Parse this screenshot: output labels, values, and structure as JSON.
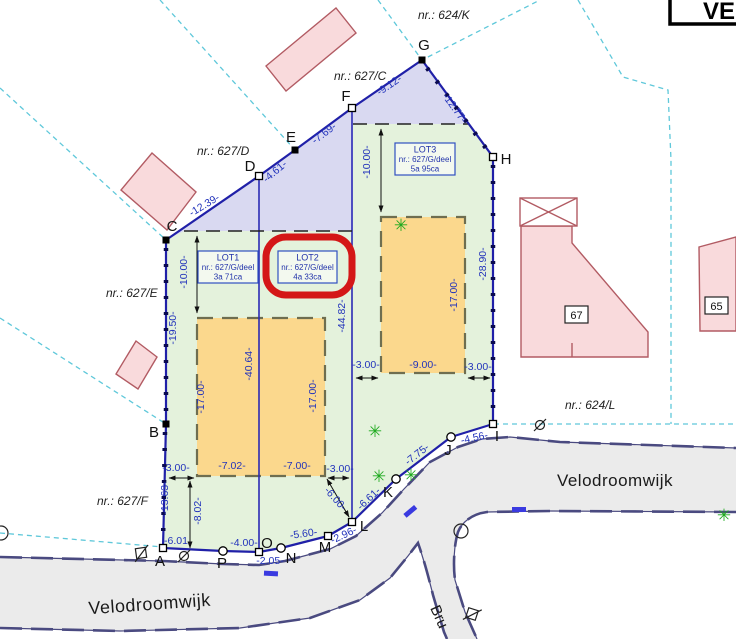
{
  "title_box": {
    "text": "VE"
  },
  "streets": {
    "velodroomwijk_left": "Velodroomwijk",
    "velodroomwijk_right": "Velodroomwijk",
    "bru": "Bru"
  },
  "lots": [
    {
      "name": "LOT1",
      "nr": "nr.: 627/G/deel",
      "area": "3a 71ca"
    },
    {
      "name": "LOT2",
      "nr": "nr.: 627/G/deel",
      "area": "4a 33ca"
    },
    {
      "name": "LOT3",
      "nr": "nr.: 627/G/deel",
      "area": "5a 95ca"
    }
  ],
  "houses": [
    {
      "number": "67"
    },
    {
      "number": "65"
    }
  ],
  "parcel_labels": [
    {
      "t": "nr.: 624/K",
      "x": 418,
      "y": 19
    },
    {
      "t": "nr.: 627/C",
      "x": 334,
      "y": 80
    },
    {
      "t": "nr.: 627/D",
      "x": 197,
      "y": 155
    },
    {
      "t": "nr.: 627/E",
      "x": 106,
      "y": 297
    },
    {
      "t": "nr.: 627/F",
      "x": 97,
      "y": 505
    },
    {
      "t": "nr.: 624/L",
      "x": 565,
      "y": 409
    }
  ],
  "points": [
    {
      "l": "A",
      "x": 163,
      "y": 548,
      "lx": 160,
      "ly": 566,
      "m": "os"
    },
    {
      "l": "B",
      "x": 166,
      "y": 424,
      "lx": 154,
      "ly": 437,
      "m": "fs"
    },
    {
      "l": "C",
      "x": 166,
      "y": 240,
      "lx": 172,
      "ly": 231,
      "m": "fs"
    },
    {
      "l": "D",
      "x": 259,
      "y": 176,
      "lx": 250,
      "ly": 171,
      "m": "os"
    },
    {
      "l": "E",
      "x": 295,
      "y": 150,
      "lx": 291,
      "ly": 142,
      "m": "fs"
    },
    {
      "l": "F",
      "x": 352,
      "y": 108,
      "lx": 346,
      "ly": 101,
      "m": "os"
    },
    {
      "l": "G",
      "x": 422,
      "y": 60,
      "lx": 424,
      "ly": 50,
      "m": "fs"
    },
    {
      "l": "H",
      "x": 493,
      "y": 157,
      "lx": 506,
      "ly": 164,
      "m": "os"
    },
    {
      "l": "I",
      "x": 493,
      "y": 424,
      "lx": 497,
      "ly": 441,
      "m": "os"
    },
    {
      "l": "J",
      "x": 451,
      "y": 437,
      "lx": 448,
      "ly": 455,
      "m": "oc"
    },
    {
      "l": "K",
      "x": 396,
      "y": 479,
      "lx": 388,
      "ly": 497,
      "m": "oc"
    },
    {
      "l": "L",
      "x": 352,
      "y": 522,
      "lx": 364,
      "ly": 531,
      "m": "os"
    },
    {
      "l": "M",
      "x": 328,
      "y": 536,
      "lx": 325,
      "ly": 552,
      "m": "os"
    },
    {
      "l": "N",
      "x": 281,
      "y": 548,
      "lx": 291,
      "ly": 563,
      "m": "oc"
    },
    {
      "l": "O",
      "x": 259,
      "y": 552,
      "lx": 267,
      "ly": 548,
      "m": "os"
    },
    {
      "l": "P",
      "x": 223,
      "y": 551,
      "lx": 222,
      "ly": 568,
      "m": "oc"
    }
  ],
  "dimensions": [
    {
      "t": "-12.39-",
      "x": 206,
      "y": 208,
      "r": -31
    },
    {
      "t": "-4.61-",
      "x": 277,
      "y": 174,
      "r": -40
    },
    {
      "t": "-7.69-",
      "x": 326,
      "y": 136,
      "r": -37
    },
    {
      "t": "-9.12-",
      "x": 391,
      "y": 88,
      "r": -34
    },
    {
      "t": "-12.77-",
      "x": 452,
      "y": 110,
      "r": 54
    },
    {
      "t": "-28.90-",
      "x": 486,
      "y": 264,
      "r": -90
    },
    {
      "t": "-19.50-",
      "x": 176,
      "y": 328,
      "r": -90
    },
    {
      "t": "-13.63-",
      "x": 168,
      "y": 498,
      "r": -90
    },
    {
      "t": "-10.00-",
      "x": 187,
      "y": 272,
      "r": -90
    },
    {
      "t": "-10.00-",
      "x": 370,
      "y": 162,
      "r": -90
    },
    {
      "t": "-40.64-",
      "x": 252,
      "y": 364,
      "r": -90
    },
    {
      "t": "-44.82-",
      "x": 345,
      "y": 316,
      "r": -90
    },
    {
      "t": "-17.00-",
      "x": 204,
      "y": 397,
      "r": -90
    },
    {
      "t": "-17.00-",
      "x": 316,
      "y": 396,
      "r": -90
    },
    {
      "t": "-17.00-",
      "x": 457,
      "y": 295,
      "r": -90
    },
    {
      "t": "-7.02-",
      "x": 232,
      "y": 469,
      "r": 0
    },
    {
      "t": "-7.00-",
      "x": 297,
      "y": 469,
      "r": 0
    },
    {
      "t": "-9.00-",
      "x": 423,
      "y": 368,
      "r": 0
    },
    {
      "t": "-3.00-",
      "x": 176,
      "y": 471,
      "r": 0
    },
    {
      "t": "-3.00-",
      "x": 340,
      "y": 472,
      "r": 0
    },
    {
      "t": "-3.00-",
      "x": 366,
      "y": 368,
      "r": 0
    },
    {
      "t": "-3.00-",
      "x": 478,
      "y": 370,
      "r": 0
    },
    {
      "t": "-8.02-",
      "x": 201,
      "y": 511,
      "r": -90
    },
    {
      "t": "-6.01",
      "x": 176,
      "y": 544,
      "r": 0
    },
    {
      "t": "-4.00-",
      "x": 244,
      "y": 546,
      "r": 0
    },
    {
      "t": "-2.05-",
      "x": 270,
      "y": 564,
      "r": 0
    },
    {
      "t": "-5.60-",
      "x": 304,
      "y": 537,
      "r": -8
    },
    {
      "t": "-2.96-",
      "x": 345,
      "y": 538,
      "r": -25
    },
    {
      "t": "-6.00-",
      "x": 333,
      "y": 501,
      "r": 48
    },
    {
      "t": "-6.61-",
      "x": 371,
      "y": 501,
      "r": -43
    },
    {
      "t": "-7.75-",
      "x": 419,
      "y": 457,
      "r": -38
    },
    {
      "t": "-4.56-",
      "x": 475,
      "y": 441,
      "r": -12
    }
  ],
  "trees": [
    {
      "x": 401,
      "y": 231
    },
    {
      "x": 375,
      "y": 437
    },
    {
      "x": 379,
      "y": 482
    },
    {
      "x": 411,
      "y": 481
    },
    {
      "x": 724,
      "y": 521
    }
  ],
  "colors": {
    "accent_blue": "#2020a8",
    "dim_text": "#2233bb",
    "lot_green": "#e4f2dc",
    "strip_purple": "#d9d9f1",
    "zone_yellow": "#fbd88d",
    "zone_border": "#6e6e50",
    "building_pink": "#f9dadc",
    "building_stroke": "#b25b63",
    "red_annotation": "#d41717",
    "street_gray": "#ebebeb",
    "street_border": "#4a4a80",
    "cadastral_cyan": "#5fc8da"
  }
}
